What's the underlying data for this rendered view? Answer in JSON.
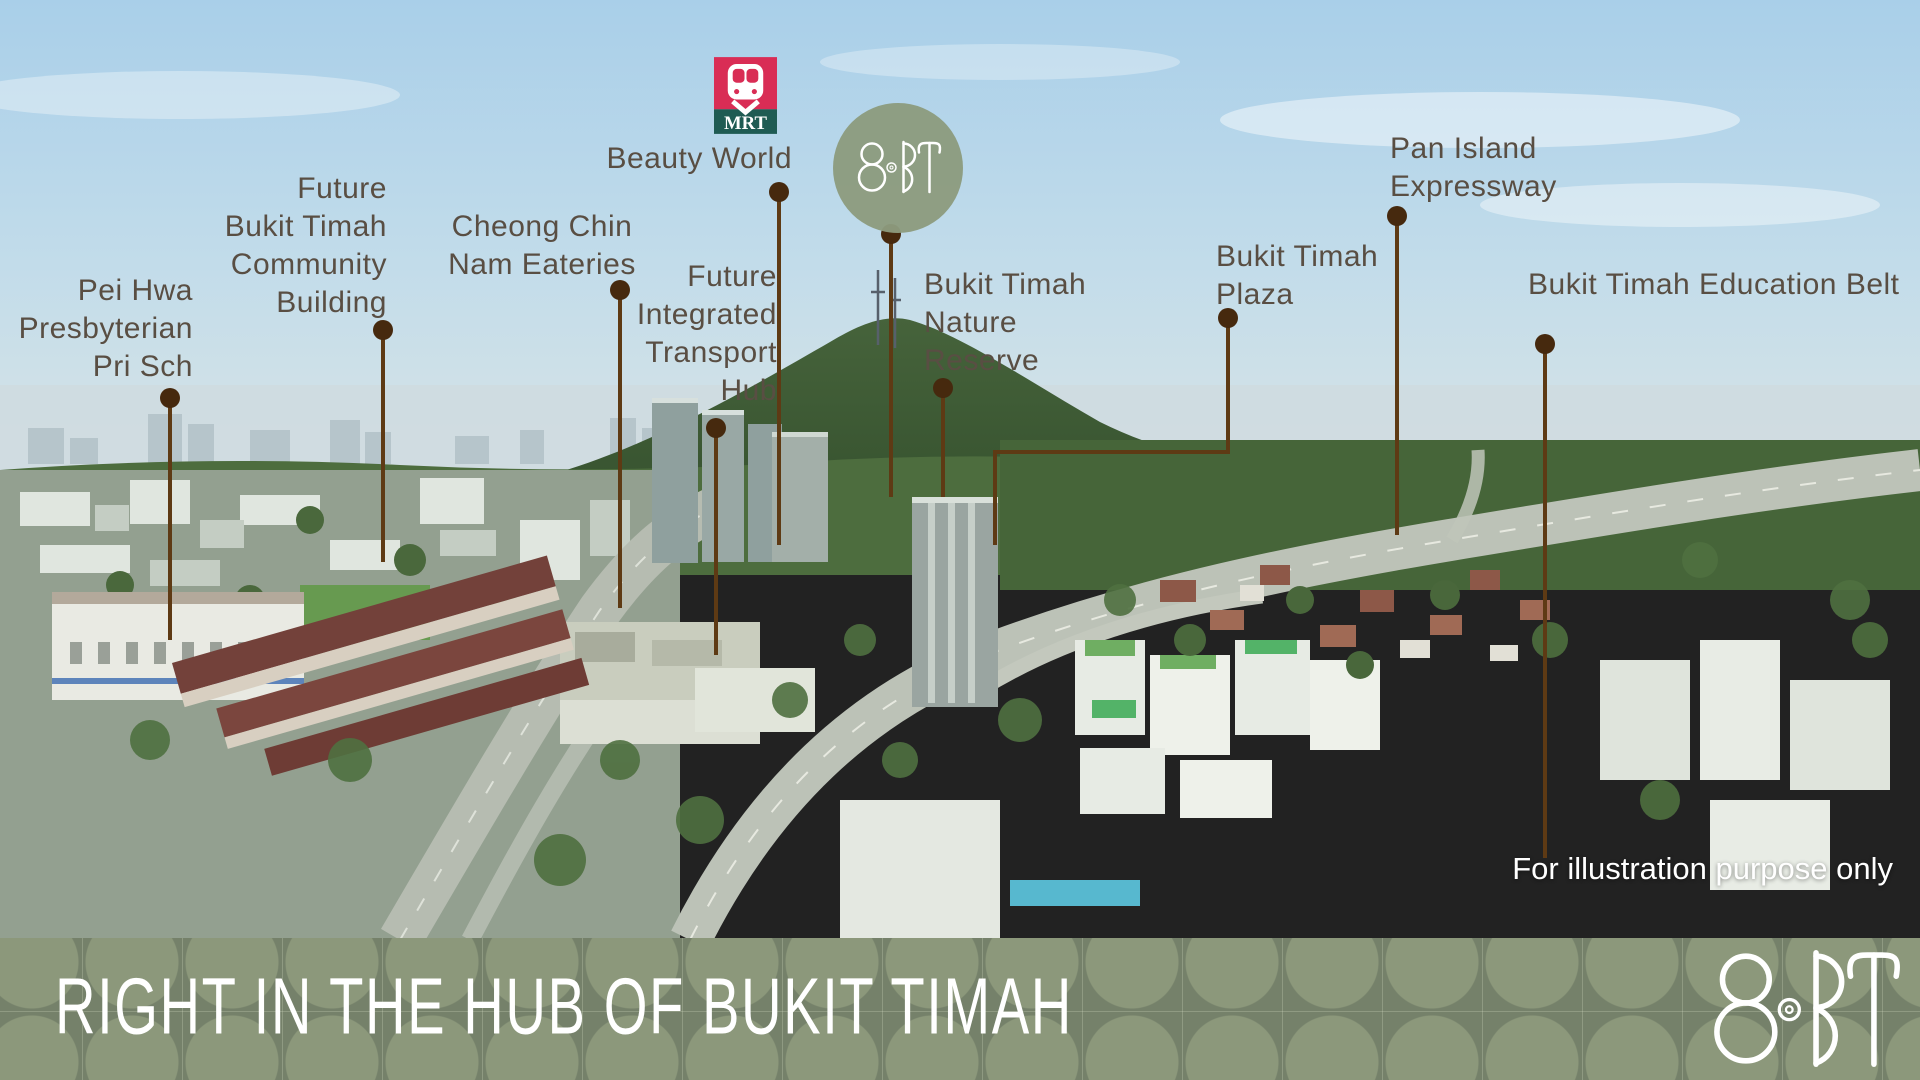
{
  "colors": {
    "callout_line": "#5e3a14",
    "callout_dot": "#46290e",
    "label_text": "#594e43",
    "banner_green": "#75816a",
    "banner_pattern_green": "#8c987b",
    "logo_circle_green": "#8d9b7e",
    "mrt_pink": "#d92d55",
    "mrt_teal": "#1f5b53",
    "text_white": "#ffffff"
  },
  "mrt_badge": {
    "icon": "mrt-train-icon",
    "label": "MRT"
  },
  "project": {
    "name": "8@BT"
  },
  "map": {
    "disclaimer": "For illustration purpose only",
    "markers": [
      {
        "id": "pei-hwa-presbyterian-pri-sch",
        "lines": [
          "Pei Hwa",
          "Presbyterian",
          "Pri Sch"
        ],
        "align": "right",
        "x": 193,
        "y": 272,
        "dot": [
          170,
          398
        ],
        "path": [
          [
            170,
            398
          ],
          [
            170,
            640
          ]
        ]
      },
      {
        "id": "future-bukit-timah-community-building",
        "lines": [
          "Future",
          "Bukit Timah",
          "Community",
          "Building"
        ],
        "align": "right",
        "x": 387,
        "y": 170,
        "dot": [
          383,
          330
        ],
        "path": [
          [
            383,
            330
          ],
          [
            383,
            562
          ]
        ]
      },
      {
        "id": "cheong-chin-nam-eateries",
        "lines": [
          "Cheong Chin",
          "Nam Eateries"
        ],
        "align": "center",
        "x": 542,
        "y": 208,
        "dot": [
          620,
          290
        ],
        "path": [
          [
            620,
            290
          ],
          [
            620,
            608
          ]
        ]
      },
      {
        "id": "future-integrated-transport-hub",
        "lines": [
          "Future",
          "Integrated",
          "Transport",
          "Hub"
        ],
        "align": "right",
        "x": 777,
        "y": 258,
        "dot": [
          716,
          428
        ],
        "path": [
          [
            716,
            428
          ],
          [
            716,
            655
          ]
        ]
      },
      {
        "id": "beauty-world-mrt",
        "lines": [
          "Beauty World"
        ],
        "align": "right",
        "x": 792,
        "y": 140,
        "dot": [
          779,
          192
        ],
        "path": [
          [
            779,
            192
          ],
          [
            779,
            545
          ]
        ]
      },
      {
        "id": "eight-at-bt-site",
        "lines": [],
        "align": "left",
        "x": 0,
        "y": 0,
        "dot": [
          891,
          234
        ],
        "path": [
          [
            891,
            234
          ],
          [
            891,
            497
          ]
        ]
      },
      {
        "id": "bukit-timah-nature-reserve",
        "lines": [
          "Bukit Timah",
          "Nature",
          "Reserve"
        ],
        "align": "left",
        "x": 924,
        "y": 266,
        "dot": [
          943,
          388
        ],
        "path": [
          [
            943,
            388
          ],
          [
            943,
            497
          ]
        ]
      },
      {
        "id": "bukit-timah-plaza",
        "lines": [
          "Bukit Timah",
          "Plaza"
        ],
        "align": "left",
        "x": 1216,
        "y": 238,
        "dot": [
          1228,
          318
        ],
        "path": [
          [
            1228,
            318
          ],
          [
            1228,
            452
          ],
          [
            995,
            452
          ],
          [
            995,
            545
          ]
        ]
      },
      {
        "id": "pan-island-expressway",
        "lines": [
          "Pan Island",
          "Expressway"
        ],
        "align": "left",
        "x": 1390,
        "y": 130,
        "dot": [
          1397,
          216
        ],
        "path": [
          [
            1397,
            216
          ],
          [
            1397,
            535
          ]
        ]
      },
      {
        "id": "bukit-timah-education-belt",
        "lines": [
          "Bukit Timah Education Belt"
        ],
        "align": "left",
        "x": 1528,
        "y": 266,
        "dot": [
          1545,
          344
        ],
        "path": [
          [
            1545,
            344
          ],
          [
            1545,
            858
          ]
        ]
      }
    ]
  },
  "banner": {
    "title": "RIGHT IN THE HUB OF BUKIT TIMAH",
    "logo_text": "8@BT"
  }
}
